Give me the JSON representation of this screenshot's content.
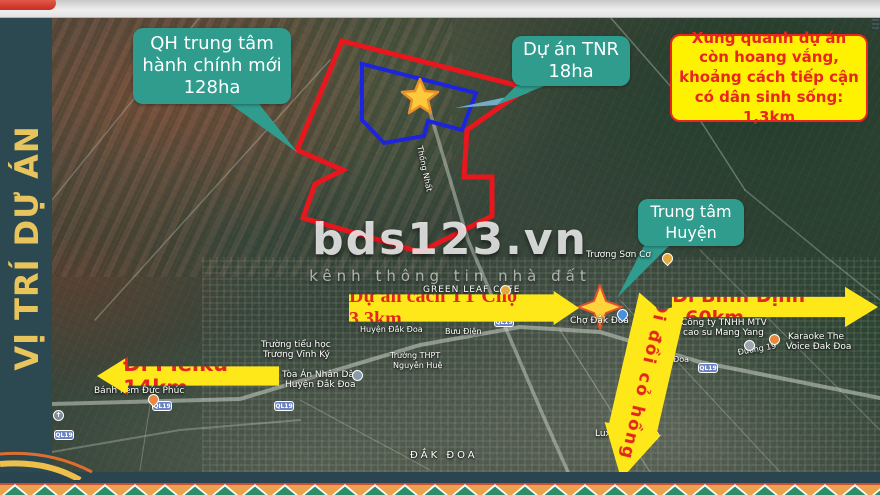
{
  "sidebar": {
    "title": "VỊ TRÍ DỰ ÁN"
  },
  "callouts": {
    "qh": {
      "text": "QH trung tâm hành chính mới 128ha"
    },
    "tnr": {
      "text": "Dự án TNR 18ha"
    },
    "district_center": {
      "text": "Trung tâm Huyện"
    }
  },
  "warning": {
    "text": "Xung quanh dự án còn hoang vắng, khoảng cách tiếp cận có dân sinh sống: 1,3km"
  },
  "arrows": {
    "pleiku": {
      "label": "Đi Pleiku 14km",
      "direction": "left"
    },
    "binh_dinh": {
      "label": "Đi Bình Định 160km",
      "direction": "right"
    },
    "cho": {
      "label": "Dự án cách TT Chợ 3,3km",
      "direction": "right"
    },
    "doi_co_hong": {
      "label": "Đi đồi cỏ hồng",
      "direction": "down"
    }
  },
  "watermark": {
    "title": "bds123.vn",
    "subtitle": "kênh thông tin nhà đất"
  },
  "colors": {
    "sidebar_bg": "#2C4851",
    "sidebar_text": "#E7C45C",
    "callout_teal": "#2F9C8E",
    "warning_yellow": "#FFF200",
    "arrow_yellow": "#FFE81A",
    "accent_red": "#E8251F",
    "boundary_red": "#E8161D",
    "boundary_blue": "#1D24DD",
    "star_gold": "#FFC93C"
  },
  "map": {
    "red_polygon": "342,41 527,88 467,130 464,177 492,177 492,216 420,252 303,218 315,184 343,170 297,150",
    "blue_polygon": "362,64 476,93 462,130 428,121 424,136 384,143 362,120",
    "star_points": "420,79 425,91 438,92 428,100 431,113 420,106 409,113 412,100 402,92 415,91",
    "sparkle_points": "600,285 606,301 622,307 606,313 600,329 594,313 578,307 594,301",
    "labels": [
      {
        "text": "Trương Sơn Cơ",
        "x": 586,
        "y": 250,
        "fs": 9
      },
      {
        "text": "GREEN LEAF CAFE",
        "x": 423,
        "y": 285,
        "fs": 9,
        "ls": 1
      },
      {
        "text": "Chợ Đắk Đoa",
        "x": 570,
        "y": 316,
        "fs": 9
      },
      {
        "text": "Công ty TNHH MTV",
        "x": 681,
        "y": 318,
        "fs": 9
      },
      {
        "text": "cao su Mang Yang",
        "x": 683,
        "y": 328,
        "fs": 9
      },
      {
        "text": "Karaoke The",
        "x": 788,
        "y": 332,
        "fs": 9
      },
      {
        "text": "Voice Đak Đoa",
        "x": 786,
        "y": 342,
        "fs": 9
      },
      {
        "text": "Đường 19",
        "x": 737,
        "y": 348,
        "fs": 8,
        "rot": -10
      },
      {
        "text": "Bưu Điện",
        "x": 445,
        "y": 327,
        "fs": 8
      },
      {
        "text": "Đền Đắk Đoa",
        "x": 636,
        "y": 355,
        "fs": 8
      },
      {
        "text": "Huyện Đắk Đoa",
        "x": 360,
        "y": 325,
        "fs": 8
      },
      {
        "text": "Luxury Coffee",
        "x": 595,
        "y": 429,
        "fs": 9
      },
      {
        "text": "Bánh kem Đức Phúc",
        "x": 94,
        "y": 386,
        "fs": 9
      },
      {
        "text": "Trường tiểu học",
        "x": 261,
        "y": 340,
        "fs": 9
      },
      {
        "text": "Trương Vĩnh Ký",
        "x": 263,
        "y": 350,
        "fs": 9
      },
      {
        "text": "Tòa Án Nhân Dân",
        "x": 282,
        "y": 370,
        "fs": 9
      },
      {
        "text": "Huyện Đắk Đoa",
        "x": 285,
        "y": 380,
        "fs": 9
      },
      {
        "text": "Trường THPT",
        "x": 390,
        "y": 351,
        "fs": 8
      },
      {
        "text": "Nguyễn Huệ",
        "x": 393,
        "y": 361,
        "fs": 8
      },
      {
        "text": "Thống Nhất",
        "x": 424,
        "y": 145,
        "fs": 8,
        "rot": 78
      },
      {
        "text": "ĐẮK ĐOA",
        "x": 410,
        "y": 450,
        "fs": 10,
        "ls": 3
      }
    ],
    "road_badges": [
      {
        "text": "QL19",
        "x": 152,
        "y": 401
      },
      {
        "text": "QL19",
        "x": 274,
        "y": 401
      },
      {
        "text": "QL19",
        "x": 494,
        "y": 317
      },
      {
        "text": "QL19",
        "x": 698,
        "y": 363
      },
      {
        "text": "QL19",
        "x": 54,
        "y": 430
      }
    ],
    "markers": [
      {
        "name": "cafe-marker",
        "x": 500,
        "y": 285,
        "c": "#E2A93B"
      },
      {
        "name": "market-marker",
        "x": 617,
        "y": 309,
        "c": "#4A8FD9",
        "tear": true
      },
      {
        "name": "karaoke-marker",
        "x": 769,
        "y": 334,
        "c": "#E8883C"
      },
      {
        "name": "coffee-marker",
        "x": 648,
        "y": 430,
        "c": "#D9A43B"
      },
      {
        "name": "bakery-marker",
        "x": 148,
        "y": 394,
        "c": "#E8883C",
        "tear": true
      },
      {
        "name": "court-marker",
        "x": 352,
        "y": 370,
        "c": "#8A9BA8"
      },
      {
        "name": "poi-marker",
        "x": 744,
        "y": 340,
        "c": "#9AA5AD"
      },
      {
        "name": "parking-marker",
        "x": 634,
        "y": 339,
        "c": "#3F72C8",
        "glyph": "P"
      },
      {
        "name": "church-marker",
        "x": 53,
        "y": 410,
        "c": "#7F8C99",
        "glyph": "✝"
      },
      {
        "name": "poi-marker",
        "x": 662,
        "y": 253,
        "c": "#E2A93B",
        "tear": true
      }
    ]
  }
}
